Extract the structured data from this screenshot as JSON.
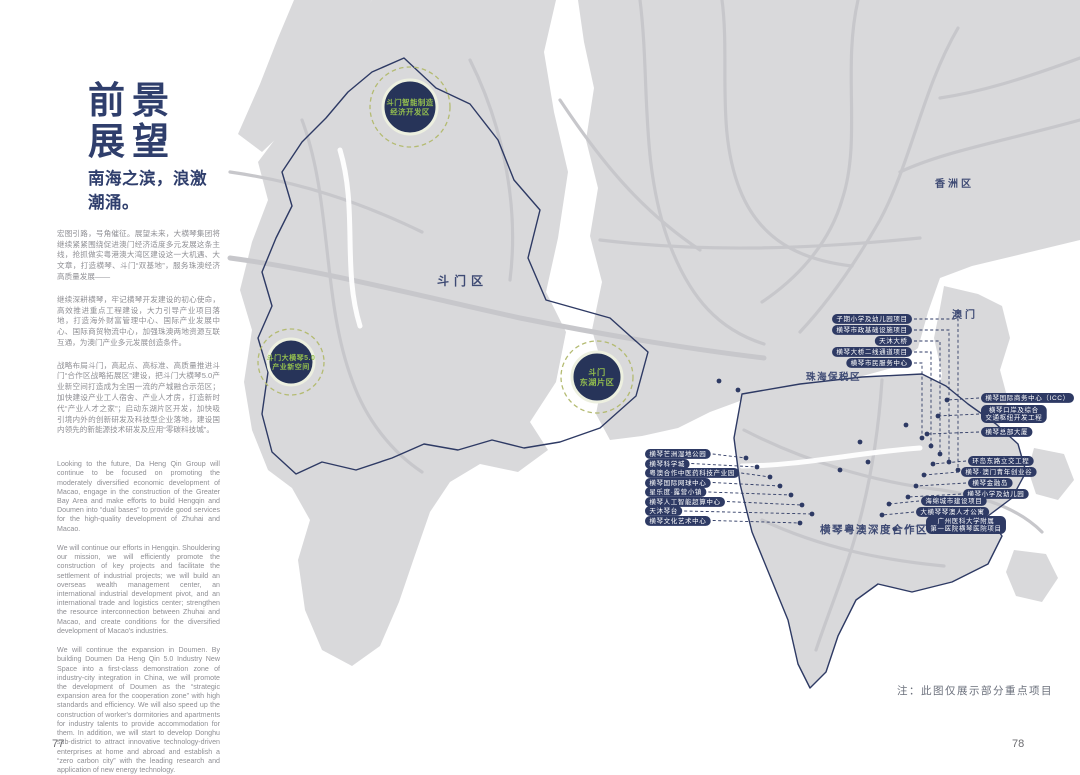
{
  "document": {
    "page_left": "77",
    "page_right": "78",
    "title": [
      "前景",
      "展望"
    ],
    "subtitle": "南海之滨，浪激潮涌。",
    "paragraphs_cn": [
      "宏图引路，号角催征。展望未来，大横琴集团将继续紧紧围绕促进澳门经济适度多元发展这条主线，抢抓做实粤港澳大湾区建设这一大机遇、大文章，打造横琴、斗门“双基地”，服务珠澳经济高质量发展——",
      "继续深耕横琴，牢记横琴开发建设的初心使命，高效推进重点工程建设，大力引导产业项目落地，打造海外财富管理中心、国际产业发展中心、国际商贸物流中心，加强珠澳两地资源互联互通，为澳门产业多元发展创造条件。",
      "战略布局斗门，高起点、高标准、高质量推进斗门“合作区战略拓展区”建设，把斗门大横琴5.0产业新空间打造成为全国一流的产城融合示范区；加快建设产业工人宿舍、产业人才房，打造新时代“产业人才之家”；启动东湖片区开发，加快吸引境内外的创新研发及科技型企业落地，建设国内领先的新能源技术研发及应用“零碳科技城”。"
    ],
    "paragraphs_en": [
      "Looking to the future, Da Heng Qin Group will continue to be focused on promoting the moderately diversified economic development of Macao, engage in the construction of the Greater Bay Area and make efforts to build Hengqin and Doumen into “dual bases” to provide good services for the high-quality development of Zhuhai and Macao.",
      "We will continue our efforts in Hengqin. Shouldering our mission, we will efficiently promote the construction of key projects and facilitate the settlement of industrial projects; we will build an overseas wealth management center, an international industrial development pivot, and an international trade and logistics center; strengthen the resource interconnection between Zhuhai and Macao, and create conditions for the diversified development of Macao's industries.",
      "We will continue the expansion in Doumen. By building Doumen Da Heng Qin 5.0 Industry New Space into a first-class demonstration zone of industry-city integration in China, we will promote the development of Doumen as the “strategic expansion area for the cooperation zone” with high standards and efficiency. We will also speed up the construction of worker's dormitories and apartments for industry talents to provide accommodation for them. In addition, we will start to develop Donghu sub-district to attract innovative technology-driven enterprises at home and abroad and establish a “zero carbon city” with the leading research and application of new energy technology."
    ],
    "map_note": "注：此图仅展示部分重点项目"
  },
  "map": {
    "colors": {
      "navy": "#2e3a64",
      "land": "#d9d9db",
      "road": "#c7c7cb",
      "green_text": "#94bf4e",
      "dash_green": "#b4bb72"
    },
    "region_labels": [
      {
        "id": "doumen",
        "text": "斗门区",
        "x": 437,
        "y": 272,
        "size": 12,
        "ls": 5
      },
      {
        "id": "xiangzhou",
        "text": "香洲区",
        "x": 935,
        "y": 175,
        "size": 10,
        "ls": 3
      },
      {
        "id": "macao",
        "text": "澳门",
        "x": 952,
        "y": 306,
        "size": 10,
        "ls": 3
      },
      {
        "id": "zhuhai-free-trade-zone",
        "text": "珠海保税区",
        "x": 806,
        "y": 369,
        "size": 9.5,
        "ls": 1.5
      },
      {
        "id": "hengqin-cooperation-zone",
        "text": "横琴粤澳深度合作区",
        "x": 820,
        "y": 522,
        "size": 10.5,
        "ls": 1.5,
        "bold": true
      }
    ],
    "zone_markers": [
      {
        "x": 410,
        "y": 107,
        "r": 27,
        "dr": 40,
        "fs": 7.4,
        "lines": [
          "斗门智能制造",
          "经济开发区"
        ]
      },
      {
        "x": 291,
        "y": 362,
        "r": 23,
        "dr": 33,
        "fs": 7.0,
        "lines": [
          "斗门大横琴5.0",
          "产业新空间"
        ]
      },
      {
        "x": 597,
        "y": 377,
        "r": 25,
        "dr": 36,
        "fs": 8.2,
        "lines": [
          "斗门",
          "东湖片区"
        ]
      }
    ],
    "label_groups": [
      {
        "name": "top-right",
        "align": "right",
        "leader": "right",
        "edge": 912,
        "items": [
          {
            "text": "子期小学及幼儿园项目",
            "y": 319,
            "elbow": 958,
            "dot": [
              958,
              470
            ]
          },
          {
            "text": "横琴市政基础设施项目",
            "y": 330,
            "elbow": 949,
            "dot": [
              949,
              462
            ]
          },
          {
            "text": "天沐大桥",
            "y": 341,
            "elbow": 940,
            "dot": [
              940,
              454
            ]
          },
          {
            "text": "横琴大桥二线通道项目",
            "y": 352,
            "elbow": 931,
            "dot": [
              931,
              446
            ]
          },
          {
            "text": "横琴市民服务中心",
            "y": 363,
            "elbow": 922,
            "dot": [
              922,
              438
            ]
          }
        ]
      },
      {
        "name": "left",
        "align": "left",
        "leader": "right",
        "edge": 645,
        "items": [
          {
            "text": "横琴芒洲湿地公园",
            "y": 454,
            "dot": [
              746,
              458
            ]
          },
          {
            "text": "横琴科学城",
            "y": 463.5,
            "dot": [
              757,
              467
            ]
          },
          {
            "text": "粤澳合作中医药科技产业园",
            "y": 473,
            "dot": [
              770,
              477
            ]
          },
          {
            "text": "横琴国际网球中心",
            "y": 482.5,
            "dot": [
              780,
              486
            ]
          },
          {
            "text": "星乐度·露营小镇",
            "y": 492,
            "dot": [
              791,
              495
            ]
          },
          {
            "text": "横琴人工智能超算中心",
            "y": 501.5,
            "dot": [
              802,
              505
            ]
          },
          {
            "text": "天沐琴台",
            "y": 511,
            "dot": [
              812,
              514
            ]
          },
          {
            "text": "横琴文化艺术中心",
            "y": 520.5,
            "dot": [
              800,
              523
            ]
          }
        ]
      },
      {
        "name": "right-upper",
        "align": "left",
        "leader": "left",
        "edge": 981,
        "items": [
          {
            "text": "横琴国际商务中心（ICC）",
            "y": 398,
            "dot": [
              947,
              400
            ]
          },
          {
            "lines": [
              "横琴口岸及综合",
              "交通枢纽开发工程"
            ],
            "y": 414,
            "dot": [
              938,
              416
            ]
          },
          {
            "text": "横琴总部大厦",
            "y": 432,
            "dot": [
              927,
              434
            ]
          }
        ]
      },
      {
        "name": "right-lower",
        "align": "left",
        "leader": "left",
        "edge": 962,
        "items": [
          {
            "text": "环岛东路立交工程",
            "x": 968,
            "y": 461,
            "dot": [
              933,
              464
            ]
          },
          {
            "text": "横琴·澳门青年创业谷",
            "x": 961,
            "y": 472,
            "dot": [
              924,
              475
            ]
          },
          {
            "text": "横琴金融岛",
            "x": 968,
            "y": 483,
            "dot": [
              916,
              486
            ]
          },
          {
            "text": "横琴小学及幼儿园",
            "x": 963,
            "y": 494,
            "dot": [
              908,
              497
            ]
          }
        ]
      },
      {
        "name": "bottom",
        "align": "left",
        "leader": "left",
        "edge": 920,
        "items": [
          {
            "text": "海绵城市建设项目",
            "x": 921,
            "y": 501,
            "dot": [
              889,
              504
            ]
          },
          {
            "text": "大横琴琴澳人才公寓",
            "x": 916,
            "y": 512,
            "dot": [
              882,
              515
            ]
          },
          {
            "lines": [
              "广州医科大学附属",
              "第一医院横琴医院项目"
            ],
            "x": 926,
            "y": 525,
            "dot": [
              895,
              529
            ]
          }
        ]
      }
    ],
    "extra_dots": [
      [
        719,
        381
      ],
      [
        738,
        390
      ],
      [
        860,
        442
      ],
      [
        906,
        425
      ],
      [
        840,
        470
      ],
      [
        868,
        462
      ]
    ]
  }
}
